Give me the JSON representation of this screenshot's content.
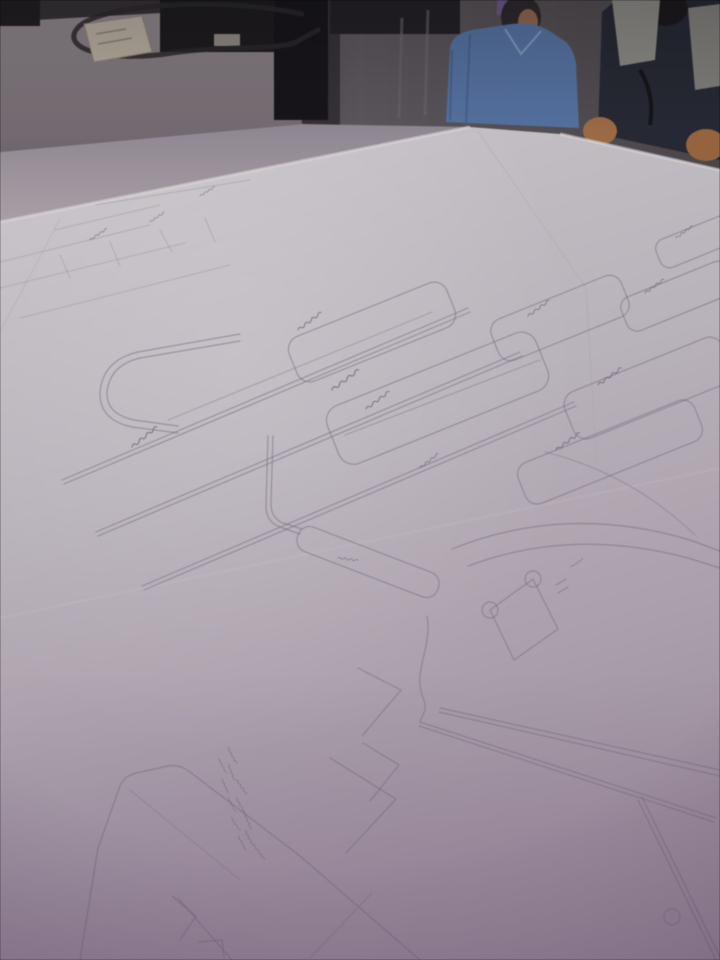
{
  "scene": {
    "type": "photograph",
    "description": "Large hand-drawn garment pattern drafting sheets spread over a cutting table, photographed at an oblique angle in a dim workshop; two workers stand behind the table",
    "setting": "pattern-making workshop",
    "text_legibility": "handwritten pattern annotations present but illegible"
  },
  "objects": {
    "room": {
      "label": "dim workshop background"
    },
    "side_table": {
      "label": "gray side table"
    },
    "cable": {
      "label": "dark power cable looped on side table"
    },
    "box": {
      "label": "small beige box on side table"
    },
    "equipment": {
      "label": "dark equipment along back edge"
    },
    "person_blue": {
      "label": "worker in blue short-sleeve shirt"
    },
    "person_vest": {
      "label": "worker in dark shirt with light gray vest"
    },
    "arms": {
      "label": "bare forearms resting at table edge"
    },
    "paper": {
      "label": "white pattern drafting paper covering table"
    },
    "paper_edge": {
      "label": "front edge of paper table"
    },
    "linework": {
      "label": "pencil pattern drafting line work"
    },
    "pattern_pieces": {
      "label": "rounded rectangular pattern pieces (cuffs, bands, collars)"
    },
    "rails": {
      "label": "long parallel double drafting lines"
    },
    "buttonhole": {
      "label": "buttonhole marking with two small circles"
    },
    "circle_mark": {
      "label": "small circle mark near bottom right"
    },
    "hanzi_block": {
      "label": "vertical column of illegible handwritten characters"
    },
    "labels": {
      "label": "scattered illegible handwritten labels"
    }
  },
  "colors": {
    "paper_top": "#c9c5c9",
    "paper_mid": "#b8b2ba",
    "paper_bottom": "#a091a0",
    "pencil": "#776b80",
    "table_gray": "#867e84",
    "wall": "#5b565c",
    "room_dark": "#2e2b30",
    "equipment": "#1d1b1f",
    "shirt_blue": "#54709e",
    "vest_gray": "#8f8e8a",
    "dark_clothes": "#262833",
    "skin": "#9a6a44",
    "box": "#b3a99c",
    "edge_highlight": "#dcd9dc"
  }
}
